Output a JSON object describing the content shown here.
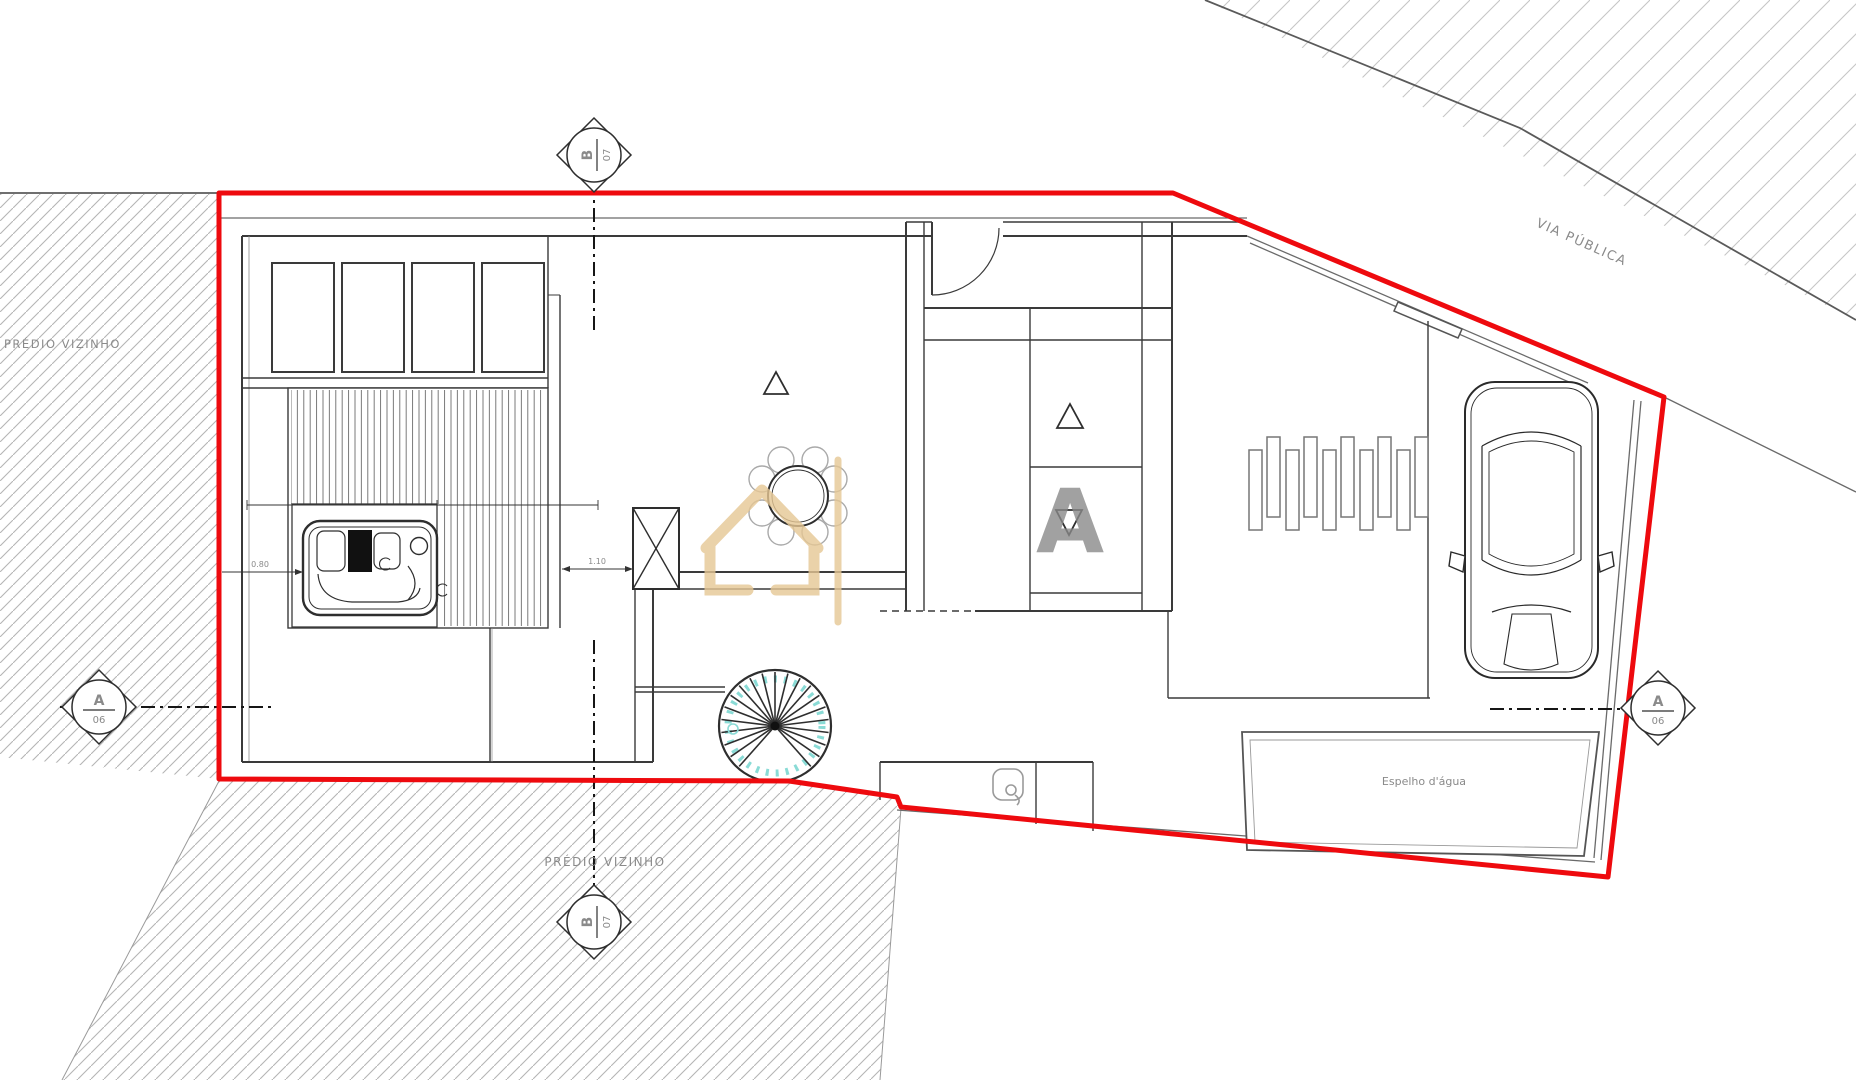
{
  "drawing": {
    "labels": {
      "neighbor_left": "PRÉDIO VIZINHO",
      "neighbor_bottom": "PRÉDIO VIZINHO",
      "public_road": "VIA PÚBLICA",
      "water_mirror": "Espelho d'água"
    },
    "section_markers": {
      "top": {
        "letter": "B",
        "number": "07"
      },
      "left": {
        "letter": "A",
        "number": "06"
      },
      "right": {
        "letter": "A",
        "number": "06"
      },
      "bottom": {
        "letter": "B",
        "number": "07"
      }
    },
    "dimensions": {
      "door_opening": "1.10",
      "jacuzzi_offset": "0.80"
    },
    "watermark": {
      "letter": "A"
    },
    "colors": {
      "boundary_red": "#ee0a0e",
      "watermark_gold": "#e6c794",
      "stair_accent": "#8adbd6",
      "hatch_gray": "#b5b5b5",
      "wall_dark": "#3a3a3a"
    },
    "symbols": [
      "spiral-staircase",
      "hot-tub",
      "dining-table",
      "car",
      "column",
      "door-swing",
      "shower-icon",
      "louver-slats",
      "skylights",
      "deck-slats"
    ]
  }
}
